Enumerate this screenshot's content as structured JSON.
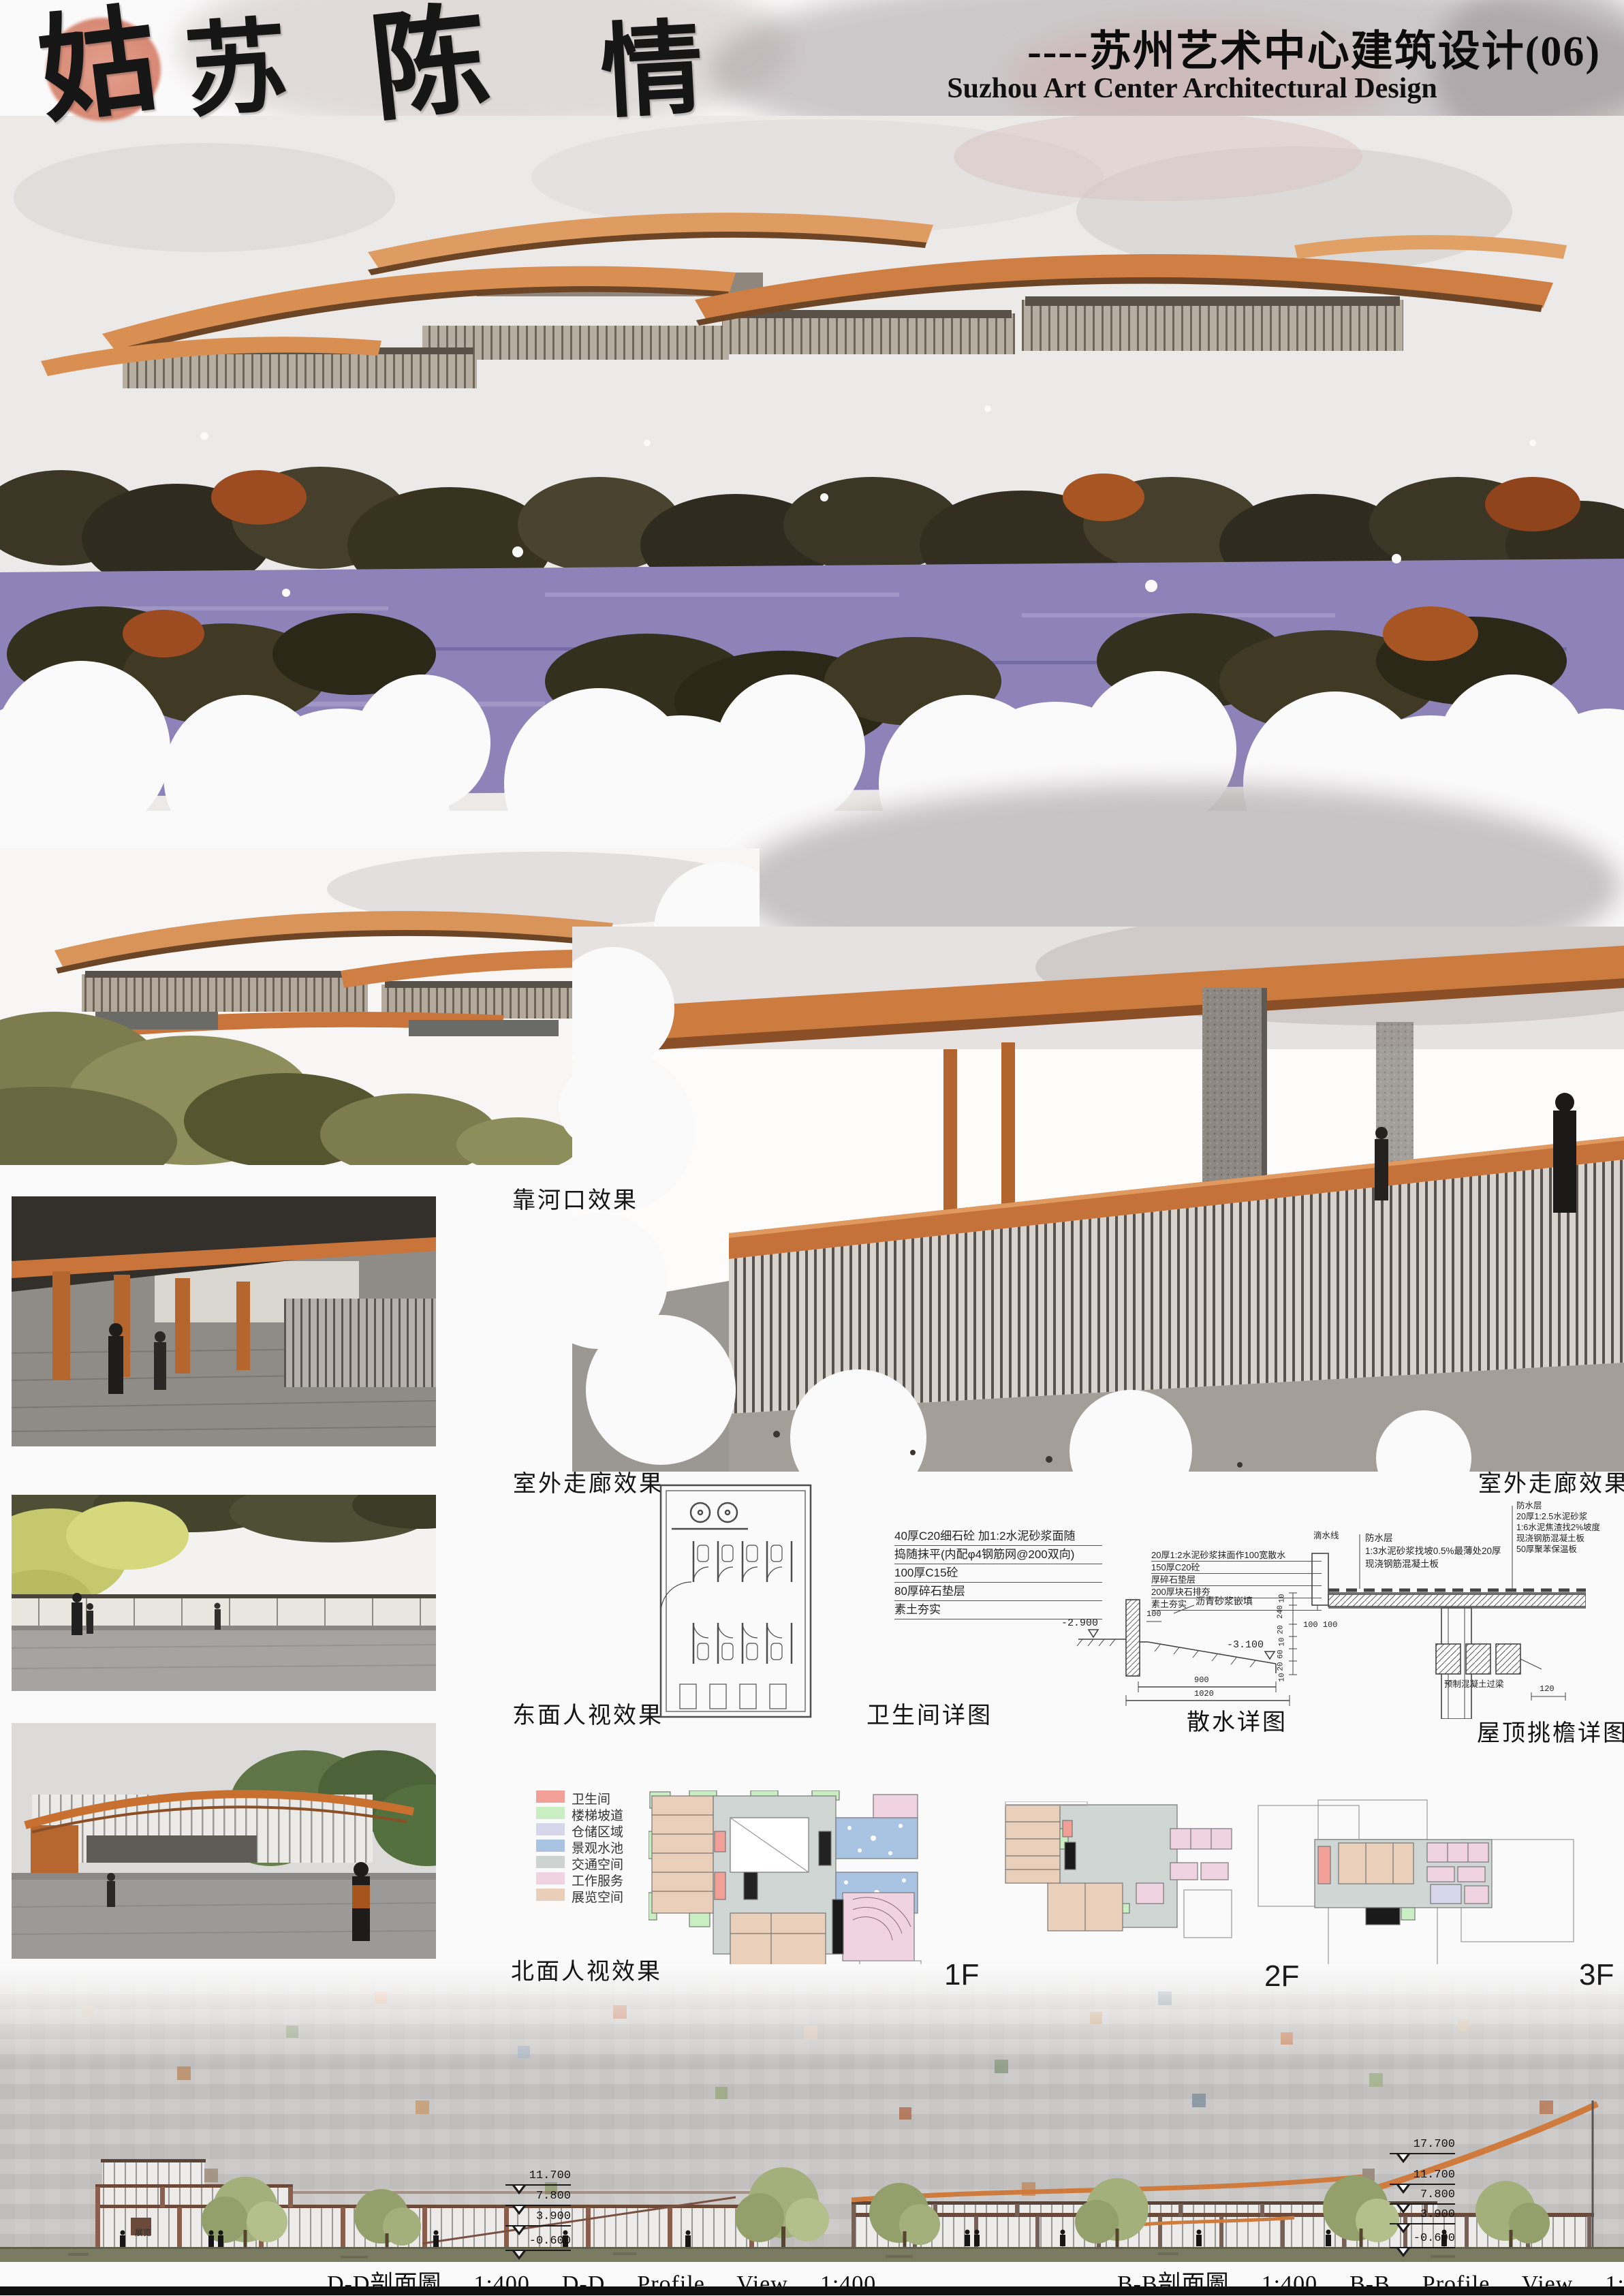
{
  "header": {
    "calligraphy_chars": [
      "姑",
      "苏",
      "陈",
      "情"
    ],
    "title_cn": "----苏州艺术中心建筑设计(06)",
    "title_en": "Suzhou Art Center Architectural Design"
  },
  "colors": {
    "seal": "#dd8a74",
    "roof_accent": "#cf7b3d"
  },
  "view_labels": {
    "river_mouth": "靠河口效果",
    "corridor_left": "室外走廊效果",
    "corridor_right": "室外走廊效果",
    "east_view": "东面人视效果",
    "north_view": "北面人视效果"
  },
  "detail_labels": {
    "toilet": "卫生间详图",
    "apron": "散水详图",
    "eave": "屋顶挑檐详图"
  },
  "floor_labels": {
    "f1": "1F",
    "f2": "2F",
    "f3": "3F"
  },
  "legend": {
    "items": [
      {
        "label": "卫生间",
        "color": "#f2a097"
      },
      {
        "label": "楼梯坡道",
        "color": "#c9eec2"
      },
      {
        "label": "仓储区域",
        "color": "#d6d5e9"
      },
      {
        "label": "景观水池",
        "color": "#a9c4e3"
      },
      {
        "label": "交通空间",
        "color": "#ccd3d1"
      },
      {
        "label": "工作服务",
        "color": "#f0d3e1"
      },
      {
        "label": "展览空间",
        "color": "#e9cfba"
      }
    ]
  },
  "apron_detail": {
    "notes_left": [
      "40厚C20细石砼 加1:2水泥砂浆面随",
      "捣随抹平(内配φ4钢筋网@200双向)",
      "100厚C15砼",
      "80厚碎石垫层",
      "素土夯实"
    ],
    "notes_right": [
      "20厚1:2水泥砂浆抹面作100宽散水",
      "150厚C20砼",
      "厚碎石垫层",
      "200厚块石排夯",
      "素土夯实"
    ],
    "fill_note": "沥青砂浆嵌填",
    "level_left": "-2.900",
    "level_right": "-3.100",
    "dim_small": "100",
    "dim_pair": "100 100",
    "dim_a": "900",
    "dim_b": "1020"
  },
  "eave_detail": {
    "drip_note": "滴水线",
    "notes_left": [
      "防水层",
      "1:3水泥砂浆找坡0.5%最薄处20厚",
      "现浇钢筋混凝土板"
    ],
    "notes_right": [
      "防水层",
      "20厚1:2.5水泥砂浆",
      "1:6水泥焦渣找2%坡度",
      "现浇钢筋混凝土板",
      "50厚聚苯保温板"
    ],
    "beam_note": "预制混凝土过梁",
    "dims_left": [
      "10",
      "240",
      "20",
      "10",
      "60",
      "20",
      "10"
    ],
    "dim_right": "120"
  },
  "sections": {
    "dd_caption": "D-D剖面圖  1:400  D-D  Profile  View  1:400",
    "bb_caption": "B-B剖面圖  1:400  B-B  Profile  View  1:400",
    "left_levels": [
      "11.700",
      "7.800",
      "3.900",
      "-0.600"
    ],
    "right_levels": [
      "17.700",
      "11.700",
      "7.800",
      "3.900",
      "-0.600"
    ],
    "room_label": "展览"
  }
}
